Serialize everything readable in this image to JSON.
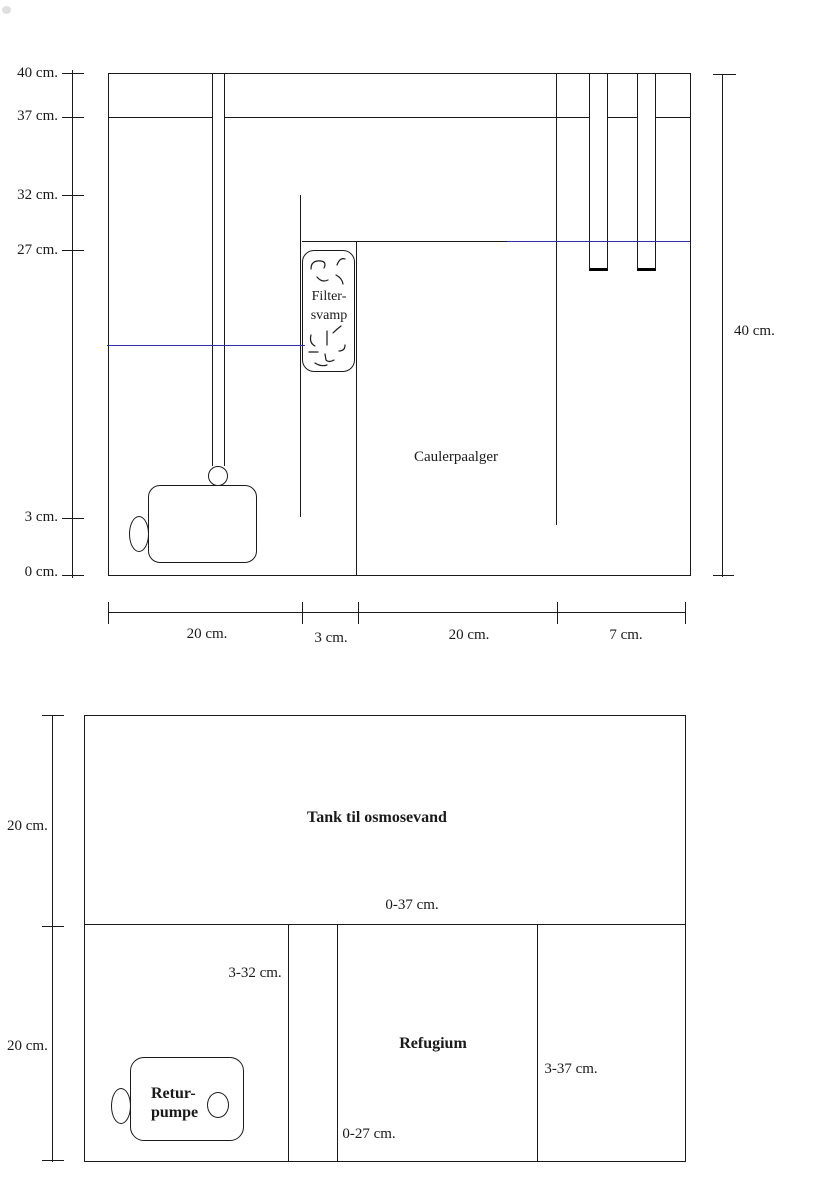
{
  "side_view": {
    "height_ruler": {
      "l40": "40 cm.",
      "l37": "37 cm.",
      "l32": "32 cm.",
      "l27": "27 cm.",
      "l3": "3 cm.",
      "l0": "0 cm."
    },
    "right_height_label": "40 cm.",
    "width_ruler": {
      "seg1": "20 cm.",
      "seg2": "3 cm.",
      "seg3": "20 cm.",
      "seg4": "7 cm."
    },
    "filter_sponge": {
      "line1": "Filter-",
      "line2": "svamp"
    },
    "caulerpa_label": "Caulerpaalger"
  },
  "top_view": {
    "depth_ruler": {
      "upper": "20 cm.",
      "lower": "20 cm."
    },
    "osmosis_tank_label": "Tank til osmosevand",
    "refugium_label": "Refugium",
    "return_pump": {
      "line1": "Retur-",
      "line2": "pumpe"
    },
    "ranges": {
      "r0_37": "0-37 cm.",
      "r3_32": "3-32 cm.",
      "r0_27": "0-27 cm.",
      "r3_37": "3-37 cm."
    }
  },
  "colors": {
    "ink": "#1a1a1a",
    "water_line": "#2f2fae",
    "background": "#ffffff"
  }
}
